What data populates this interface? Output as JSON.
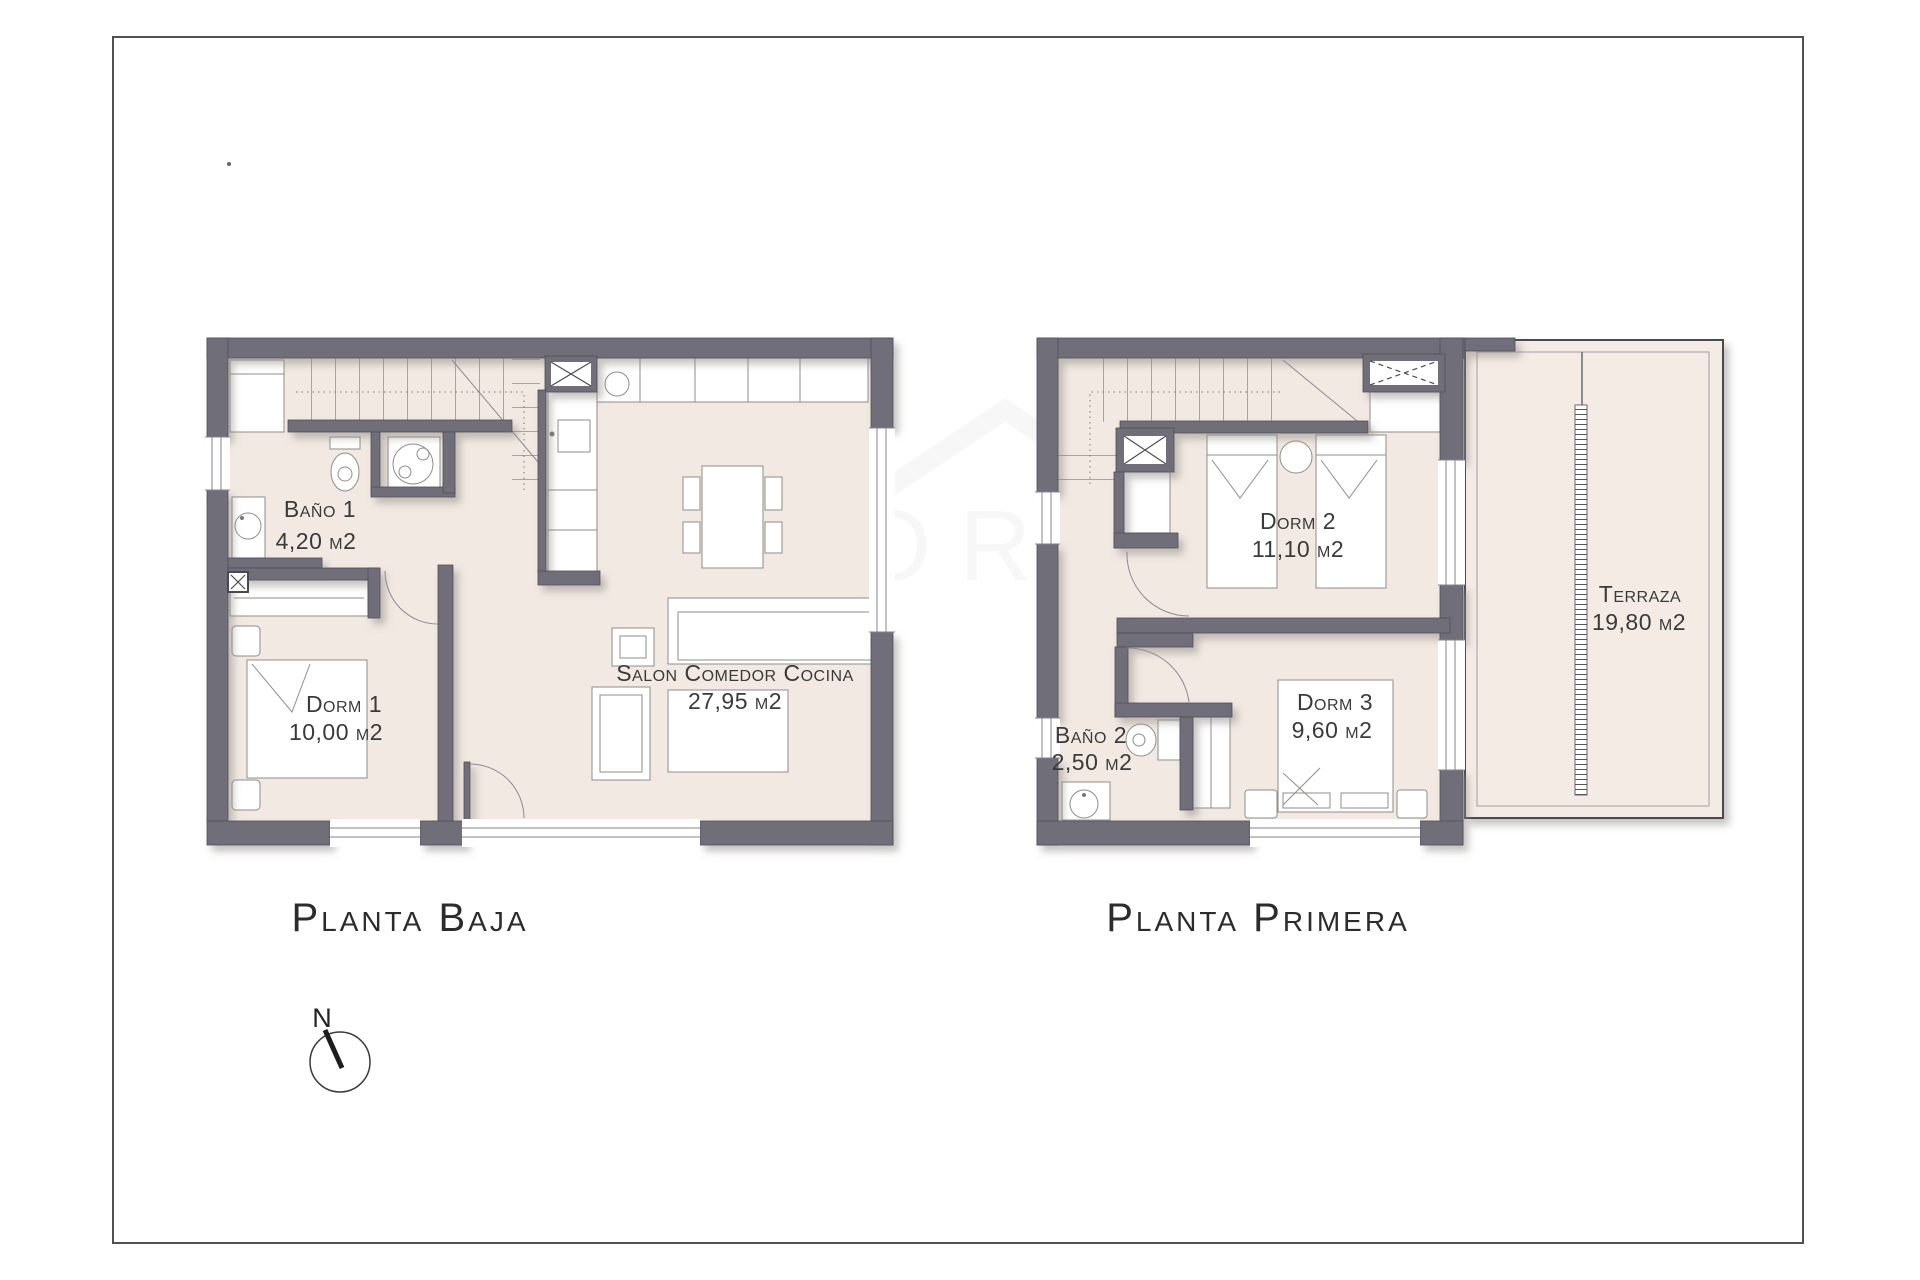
{
  "page": {
    "background": "#ffffff",
    "frame_color": "#4f4f55"
  },
  "plans": [
    {
      "title": "Planta Baja",
      "rooms": [
        {
          "name": "Baño 1",
          "area": "4,20 m2"
        },
        {
          "name": "Dorm 1",
          "area": "10,00 m2"
        },
        {
          "name": "Salon Comedor Cocina",
          "area": "27,95 m2"
        }
      ]
    },
    {
      "title": "Planta Primera",
      "rooms": [
        {
          "name": "Dorm 2",
          "area": "11,10 m2"
        },
        {
          "name": "Baño 2",
          "area": "2,50 m2"
        },
        {
          "name": "Dorm 3",
          "area": "9,60 m2"
        },
        {
          "name": "Terraza",
          "area": "19,80 m2"
        }
      ]
    }
  ],
  "compass": {
    "north_label": "N"
  },
  "colors": {
    "wall": "#6f6e78",
    "floor": "#f1e9e2",
    "terrace_floor": "#f3ebe4",
    "text": "#3a3a3a"
  }
}
